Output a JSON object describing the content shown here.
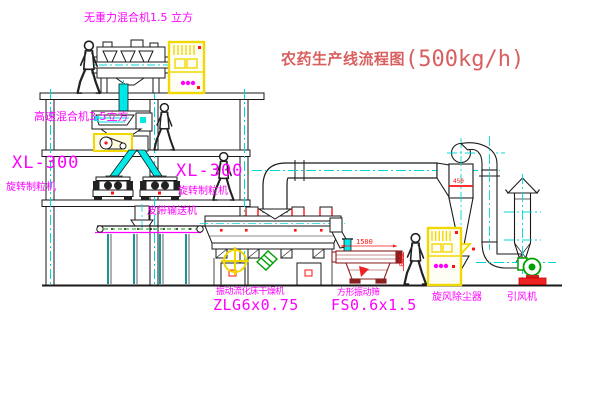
{
  "title": {
    "text_zh": "农药生产线流程图",
    "capacity": "(500kg/h)"
  },
  "labels": {
    "gravity_mixer": "无重力混合机1.5 立方",
    "high_speed_mixer": "高速混合机3.5立方",
    "granulator_left_model": "XL-300",
    "granulator_left_name": "旋转制粒机",
    "granulator_right_model": "XL-300",
    "granulator_right_name": "旋转制粒机",
    "belt_conveyor": "皮带输送机",
    "dryer_name": "振动流化床干燥机",
    "dryer_model": "ZLG6x0.75",
    "sieve_name": "方形振动筛",
    "sieve_model": "FS0.6x1.5",
    "cyclone_dust_collector": "旋风除尘器",
    "induced_draft_fan": "引风机"
  },
  "dimensions": {
    "sieve_length": "1500",
    "sieve_height": "500",
    "cyclone_width": "450"
  },
  "colors": {
    "label_magenta": "#ff00ff",
    "title_red": "#d95f5f",
    "dimension_red": "#ff1111",
    "centerline_cyan": "#00d8d8",
    "pipe_fill_cyan": "#00e8e8",
    "highlight_yellow": "#f0d800",
    "machine_green": "#00a000",
    "sieve_dark_red": "#8b2020",
    "line_black": "#1a1a1a",
    "background": "#ffffff"
  }
}
